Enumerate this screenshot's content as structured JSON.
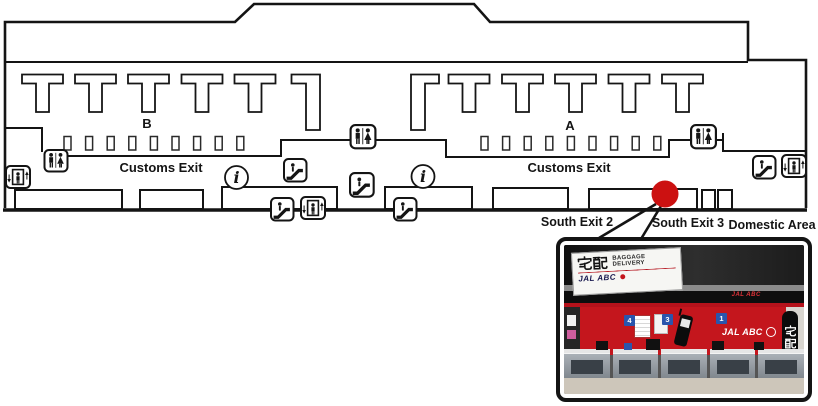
{
  "map": {
    "sections": {
      "left": "B",
      "right": "A"
    },
    "labels": {
      "customs_exit_left": "Customs Exit",
      "customs_exit_right": "Customs Exit",
      "south_exit_2": "South Exit 2",
      "south_exit_3": "South Exit 3",
      "domestic_area": "Domestic Area"
    },
    "info_symbol": "i",
    "marker": {
      "color": "#cc1111",
      "marks": "South Exit 3"
    },
    "icon_legend": [
      "restroom-icon",
      "elevator-icon",
      "escalator-icon",
      "information-icon"
    ]
  },
  "photo": {
    "hanging_sign": {
      "kanji": "宅配",
      "line1": "BAGGAGE",
      "line2": "DELIVERY",
      "brand": "JAL ABC"
    },
    "band_brand": "JAL ABC",
    "wall_brand": "JAL ABC",
    "banner_kanji": "宅配",
    "counter_numbers": [
      "4",
      "3",
      "1"
    ]
  }
}
